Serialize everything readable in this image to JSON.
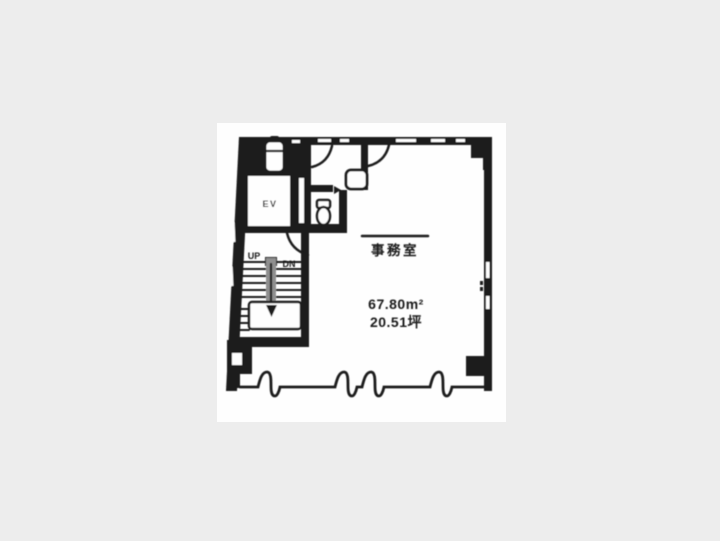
{
  "canvas": {
    "background": "#ededed",
    "paper": "#fefefe",
    "ink": "#1a1a1a",
    "stair_divider_gray": "#8f8f8f"
  },
  "labels": {
    "elevator": "EV",
    "stairs_up": "UP",
    "stairs_down": "DN",
    "room_name": "事務室",
    "area_sqm": "67.80m²",
    "area_tsubo": "20.51坪"
  }
}
